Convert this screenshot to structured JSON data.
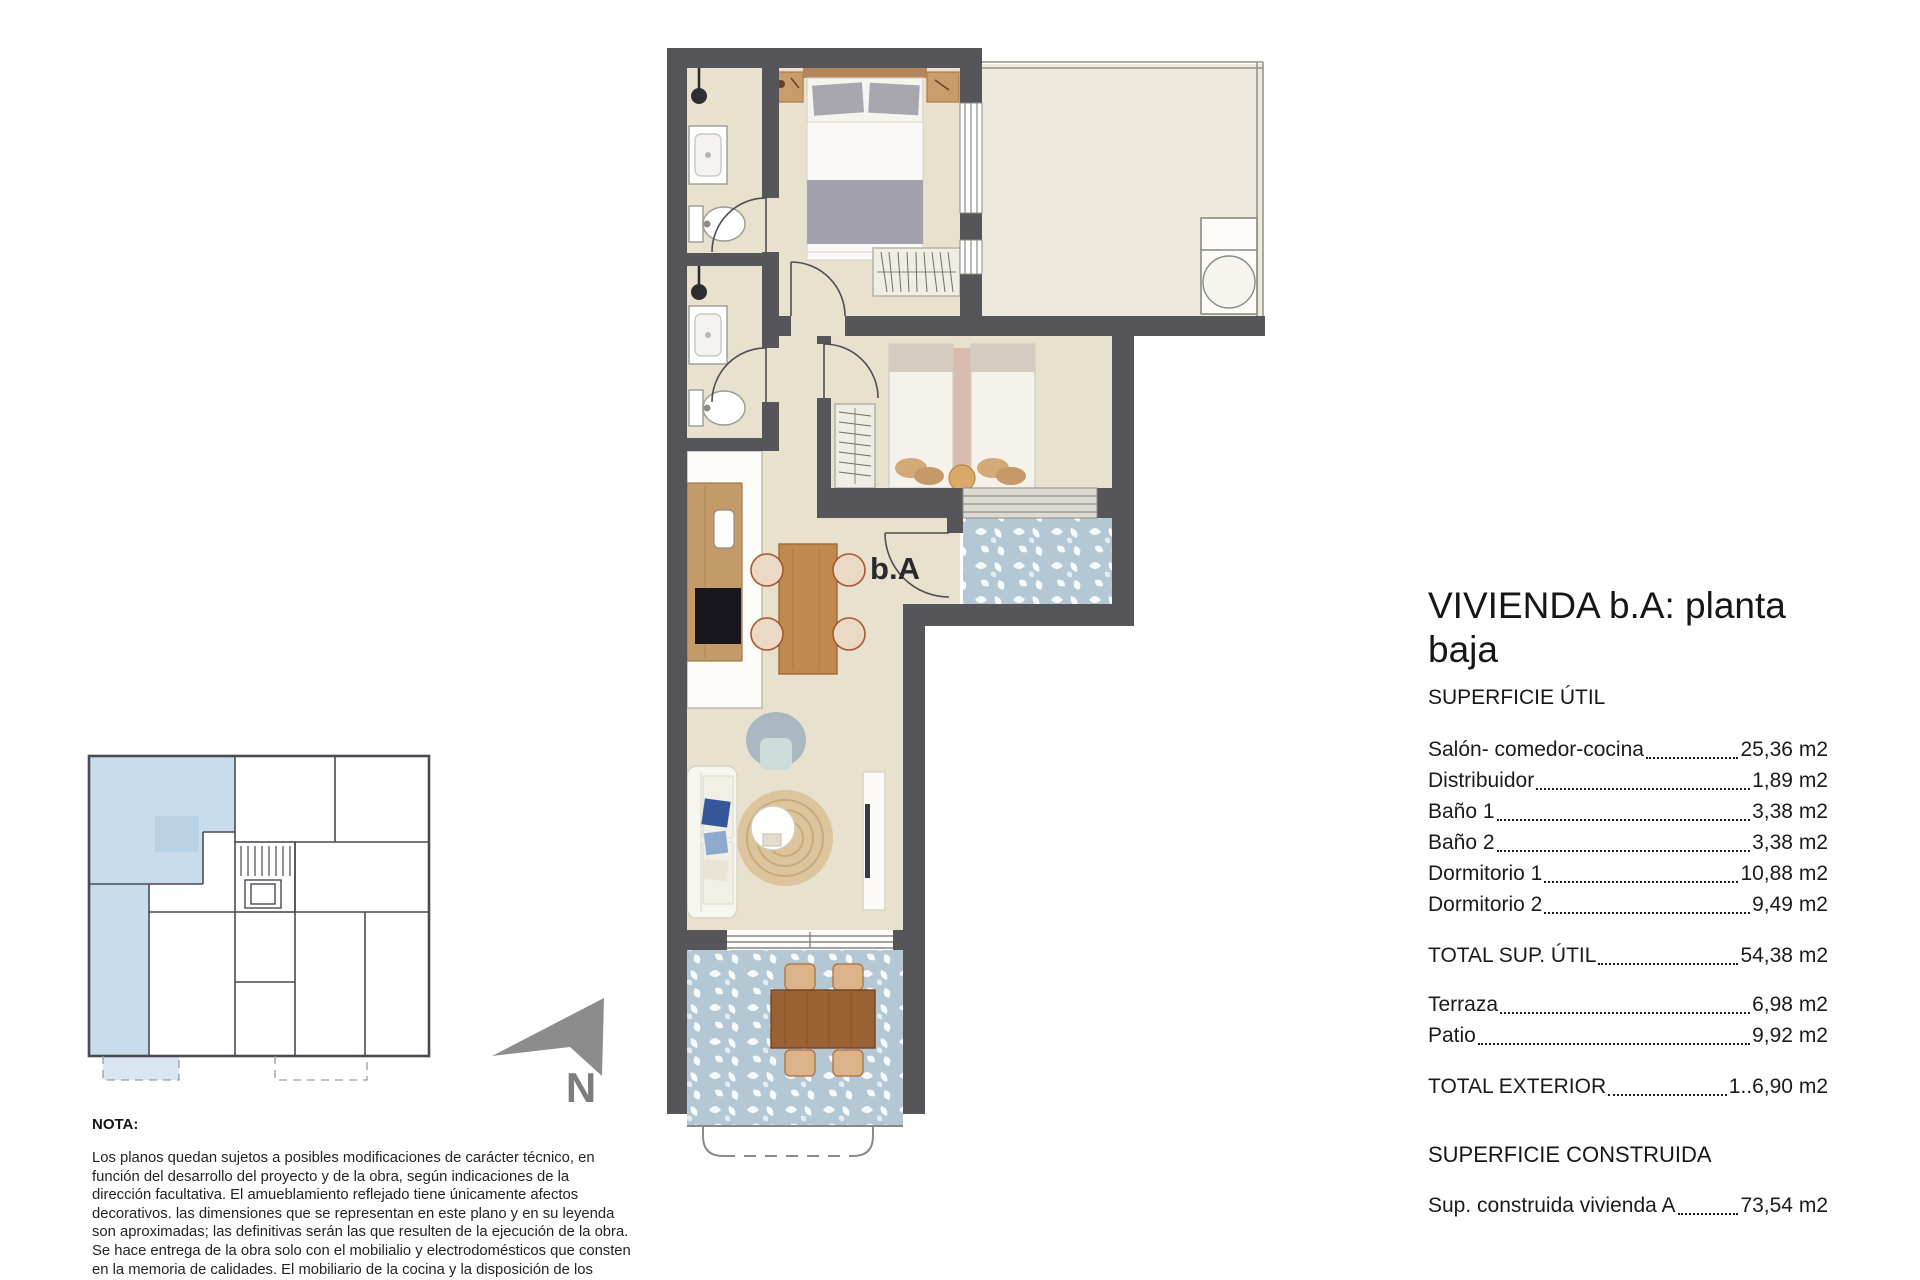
{
  "plan": {
    "entrance_label": "b.A",
    "rooms_depicted": [
      "baño 1",
      "baño 2",
      "dormitorio 1",
      "dormitorio 2",
      "salón-comedor-cocina",
      "distribuidor",
      "terraza",
      "patio"
    ]
  },
  "north": {
    "label": "N"
  },
  "panel": {
    "title": "VIVIENDA b.A: planta baja",
    "superficie_util_heading": "SUPERFICIE ÚTIL",
    "util_rows": [
      {
        "label": "Salón- comedor-cocina",
        "value": "25,36 m2"
      },
      {
        "label": "Distribuidor",
        "value": "1,89 m2"
      },
      {
        "label": "Baño 1",
        "value": "3,38 m2"
      },
      {
        "label": "Baño 2",
        "value": "3,38 m2"
      },
      {
        "label": "Dormitorio 1",
        "value": "10,88 m2"
      },
      {
        "label": "Dormitorio 2",
        "value": "9,49 m2"
      }
    ],
    "total_util": {
      "label": "TOTAL SUP. ÚTIL",
      "value": "54,38 m2"
    },
    "exterior_rows": [
      {
        "label": "Terraza",
        "value": "6,98 m2"
      },
      {
        "label": "Patio",
        "value": "9,92 m2"
      }
    ],
    "total_exterior": {
      "label": "TOTAL EXTERIOR",
      "value": "1..6,90 m2"
    },
    "superficie_construida_heading": "SUPERFICIE CONSTRUIDA",
    "construida_row": {
      "label": "Sup. construida vivienda A",
      "value": "73,54 m2"
    }
  },
  "nota": {
    "heading": "NOTA:",
    "body": "Los planos quedan sujetos a posibles modificaciones de carácter técnico, en función del desarrollo del proyecto y de la obra, según indicaciones de la dirección facultativa. El amueblamiento reflejado tiene únicamente afectos decorativos. las dimensiones que se representan en este plano y en su leyenda son aproximadas; las definitivas serán las que resulten de la ejecución de la obra. Se hace entrega de la obra solo con el mobilialio y electrodomésticos que consten en la memoria de calidades. El mobiliario de la cocina y la disposición de los sanliarios puede sufrir ligeras variaciones en función del montaje definitivo."
  },
  "colors": {
    "wall": "#56555a",
    "floor": "#e8e1ce",
    "patio_floor": "#eee9dd",
    "terrace_tile": "#b4c7d4",
    "keyplan_highlight": "#c9dcec",
    "wood": "#c08a4f",
    "text": "#1b1b1b"
  }
}
